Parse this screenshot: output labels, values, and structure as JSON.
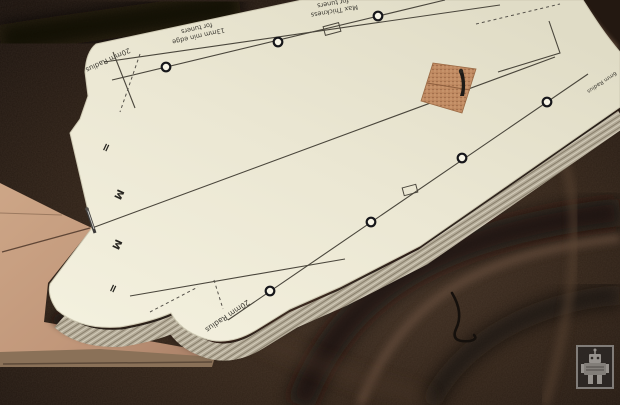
{
  "photo": {
    "subject": "guitar neck paper template stack on wood board over satin fabric",
    "colors": {
      "fabric": "#2e2119",
      "fabric_highlight": "#6b5140",
      "wood": "#c39b7c",
      "paper": "#ece8d5",
      "stack_edge": "#b3aa97",
      "print_ink": "#3c3a33",
      "cork_patch": "#c08a62"
    },
    "template_print": {
      "labels": {
        "radius_top": "20mm Radius",
        "min_edge_l1": "13mm min edge",
        "min_edge_l2": "for tuners",
        "max_thick_l1": "Max Thickness",
        "max_thick_l2": "for tuners",
        "radius_bottom": "20mm Radius",
        "radius_right": "6mm Radius"
      },
      "edge_marks": [
        "=",
        "M",
        "M",
        "="
      ],
      "tuner_hole_count": "7"
    },
    "icons": {
      "watermark": "robot-icon"
    }
  }
}
